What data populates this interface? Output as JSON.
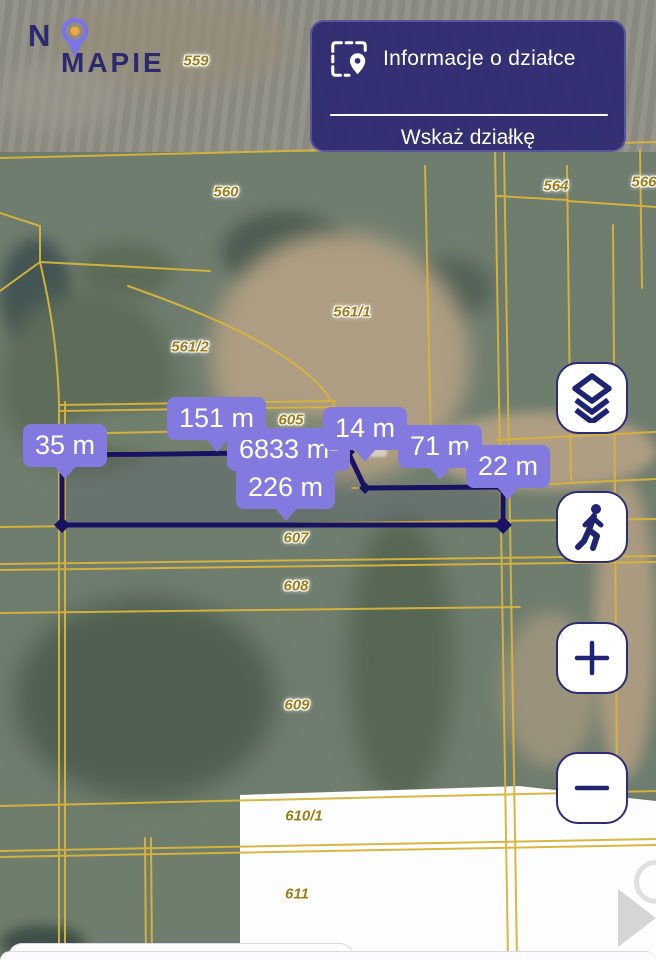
{
  "brand": {
    "name_prefix": "N",
    "name_suffix": "MAPIE",
    "pin_icon": "map-pin-logo-icon"
  },
  "panel": {
    "info_button": "Informacje o działce",
    "pick_button": "Wskaż działkę",
    "icon": "parcel-scan-pin-icon"
  },
  "measure_labels": [
    {
      "text": "35 m"
    },
    {
      "text": "151 m"
    },
    {
      "text": "6833 m²"
    },
    {
      "text": "226 m"
    },
    {
      "text": "14 m"
    },
    {
      "text": "71 m"
    },
    {
      "text": "22 m"
    }
  ],
  "parcels": [
    {
      "text": "559"
    },
    {
      "text": "560"
    },
    {
      "text": "564"
    },
    {
      "text": "566"
    },
    {
      "text": "561/1"
    },
    {
      "text": "561/2"
    },
    {
      "text": "605"
    },
    {
      "text": "607"
    },
    {
      "text": "608"
    },
    {
      "text": "609"
    },
    {
      "text": "610/1"
    },
    {
      "text": "611"
    }
  ],
  "map_controls": [
    {
      "name": "layers"
    },
    {
      "name": "street-view-walk"
    },
    {
      "name": "zoom-in"
    },
    {
      "name": "zoom-out"
    }
  ],
  "colors": {
    "panel_navy": "#302c72",
    "bubble_purple": "#837ae0",
    "cadastral_yellow": "#d8b43c",
    "parcel_text": "#9c7c1a",
    "measured_polygon": "#181263",
    "logo_navy": "#2b2a6e",
    "logo_pin_purple": "#7b74e8",
    "logo_pin_orange": "#f2a93b"
  }
}
